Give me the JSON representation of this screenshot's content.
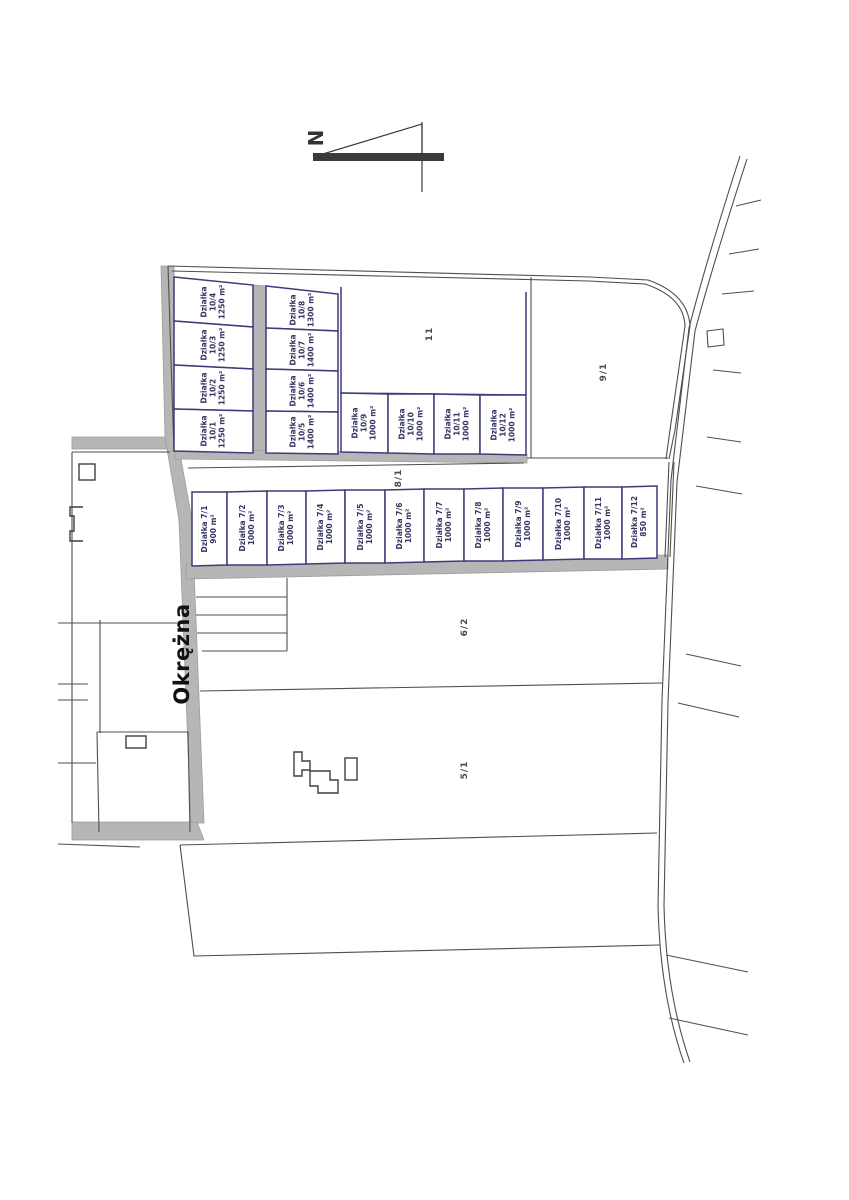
{
  "north": {
    "label": "N"
  },
  "street": {
    "name": "Okrężna"
  },
  "plots_10": [
    {
      "name": "Działka",
      "number": "10/1",
      "area": "1250 m²"
    },
    {
      "name": "Działka",
      "number": "10/2",
      "area": "1250 m²"
    },
    {
      "name": "Działka",
      "number": "10/3",
      "area": "1250 m²"
    },
    {
      "name": "Działka",
      "number": "10/4",
      "area": "1250 m²"
    },
    {
      "name": "Działka",
      "number": "10/5",
      "area": "1400 m²"
    },
    {
      "name": "Działka",
      "number": "10/6",
      "area": "1400 m²"
    },
    {
      "name": "Działka",
      "number": "10/7",
      "area": "1400 m²"
    },
    {
      "name": "Działka",
      "number": "10/8",
      "area": "1300 m²"
    },
    {
      "name": "Działka",
      "number": "10/9",
      "area": "1000 m²"
    },
    {
      "name": "Działka",
      "number": "10/10",
      "area": "1000 m²"
    },
    {
      "name": "Działka",
      "number": "10/11",
      "area": "1000 m²"
    },
    {
      "name": "Działka",
      "number": "10/12",
      "area": "1000 m²"
    }
  ],
  "plots_7": [
    {
      "name": "Działka",
      "number": "7/1",
      "area": "900 m²"
    },
    {
      "name": "Działka",
      "number": "7/2",
      "area": "1000 m²"
    },
    {
      "name": "Działka",
      "number": "7/3",
      "area": "1000 m²"
    },
    {
      "name": "Działka",
      "number": "7/4",
      "area": "1000 m²"
    },
    {
      "name": "Działka",
      "number": "7/5",
      "area": "1000 m²"
    },
    {
      "name": "Działka",
      "number": "7/6",
      "area": "1000 m²"
    },
    {
      "name": "Działka",
      "number": "7/7",
      "area": "1000 m²"
    },
    {
      "name": "Działka",
      "number": "7/8",
      "area": "1000 m²"
    },
    {
      "name": "Działka",
      "number": "7/9",
      "area": "1000 m²"
    },
    {
      "name": "Działka",
      "number": "7/10",
      "area": "1000 m²"
    },
    {
      "name": "Działka",
      "number": "7/11",
      "area": "1000 m²"
    },
    {
      "name": "Działka",
      "number": "7/12",
      "area": "850 m²"
    }
  ],
  "parcels": [
    {
      "label": "11"
    },
    {
      "label": "9/1"
    },
    {
      "label": "8/1"
    },
    {
      "label": "6/2"
    },
    {
      "label": "5/1"
    }
  ],
  "colors": {
    "plot_border": "#3c3c7a",
    "plot_text": "#353564",
    "boundary_line": "#4f4f4f",
    "road_fill": "#b6b6b6",
    "street_text": "#111111",
    "parcel_text": "#4a4a4a",
    "north_arrow": "#3a3a3a"
  }
}
